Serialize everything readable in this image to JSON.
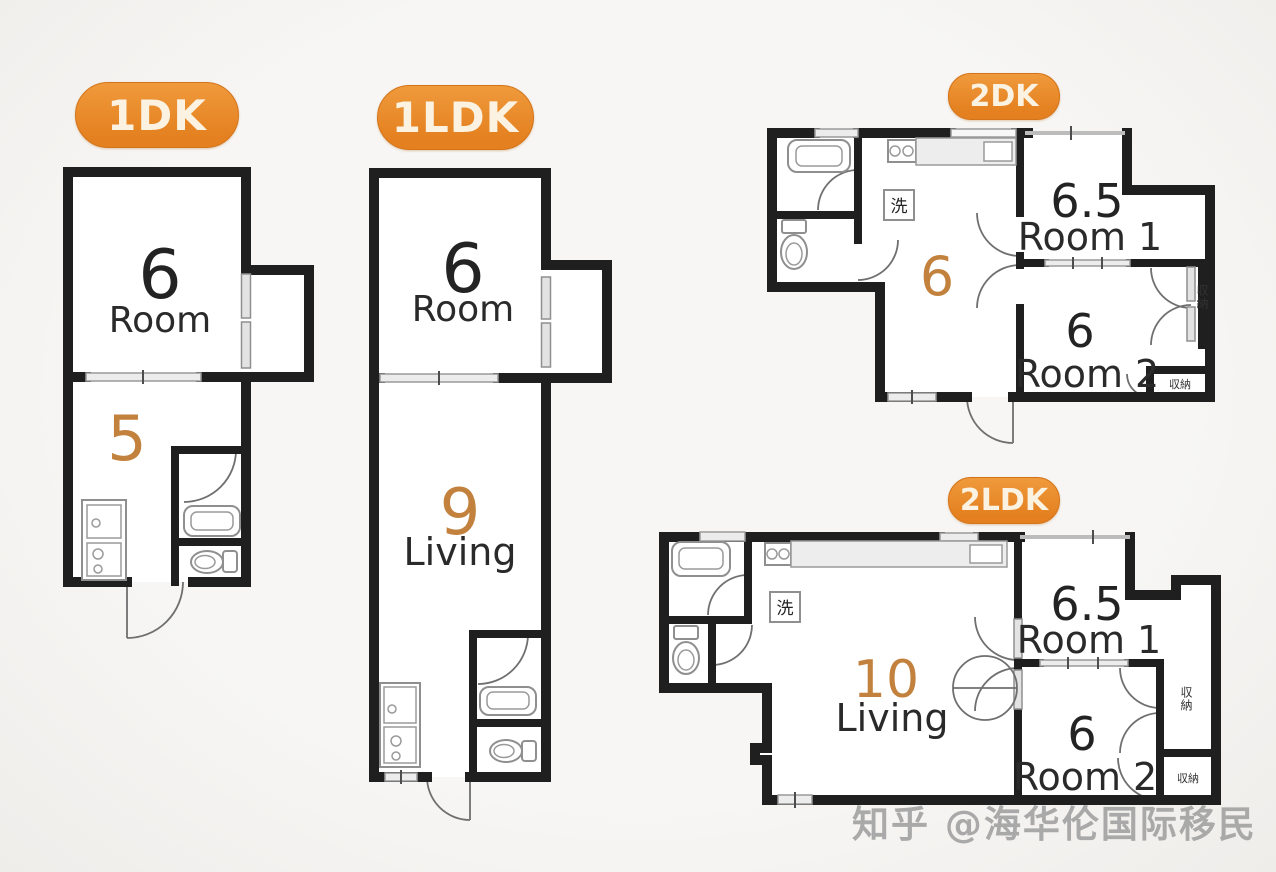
{
  "page": {
    "background": "#f5f4f1",
    "wall_color": "#1f1f1f",
    "accent_orange": "#e8872c",
    "number_orange": "#c2813d"
  },
  "watermark": {
    "text": "知乎 @海华伦国际移民"
  },
  "plans": {
    "p1dk": {
      "badge": "1DK",
      "room": {
        "size": "6",
        "label": "Room"
      },
      "dk": {
        "size": "5"
      }
    },
    "p1ldk": {
      "badge": "1LDK",
      "room": {
        "size": "6",
        "label": "Room"
      },
      "living": {
        "size": "9",
        "label": "Living"
      }
    },
    "p2dk": {
      "badge": "2DK",
      "dk": {
        "size": "6"
      },
      "room1": {
        "size": "6.5",
        "label": "Room 1"
      },
      "room2": {
        "size": "6",
        "label": "Room 2"
      },
      "wash": "洗",
      "closet_side": "収納",
      "closet_bottom": "収納"
    },
    "p2ldk": {
      "badge": "2LDK",
      "living": {
        "size": "10",
        "label": "Living"
      },
      "room1": {
        "size": "6.5",
        "label": "Room 1"
      },
      "room2": {
        "size": "6",
        "label": "Room 2"
      },
      "wash": "洗",
      "closet_side": "収納",
      "closet_bottom": "収納"
    }
  }
}
